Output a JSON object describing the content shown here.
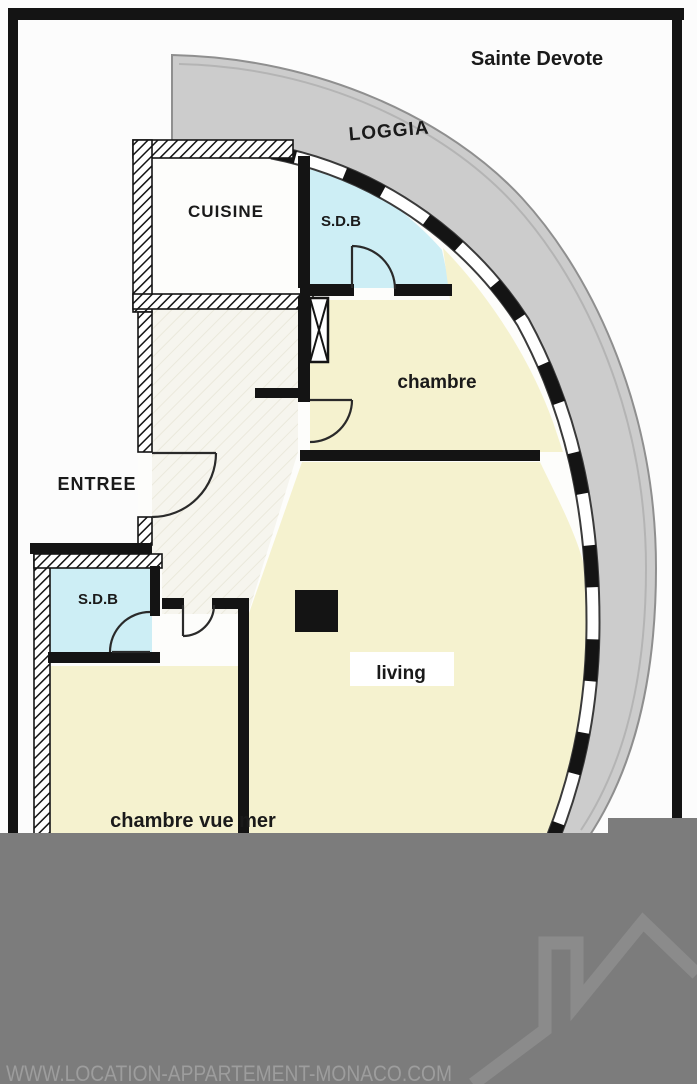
{
  "plan": {
    "region_label": "Sainte Devote",
    "rooms": {
      "loggia": "LOGGIA",
      "cuisine": "CUISINE",
      "sdb_top": "S.D.B",
      "chambre": "chambre",
      "entree": "ENTREE",
      "sdb_bottom": "S.D.B",
      "living": "living",
      "chambre_vue_mer": "chambre vue mer"
    },
    "colors": {
      "wall": "#141414",
      "label_text": "#1a1a1a",
      "loggia_fill": "#cccccc",
      "loggia_edge": "#8f8f8f",
      "room_yellow": "#f5f2cf",
      "bathroom_blue": "#cdeef5",
      "apartment_floor": "#fdfdfb",
      "overlay_gray": "#7c7c7c",
      "watermark_gray": "#8b8b8b",
      "url_text_color": "#9d9d9d"
    }
  },
  "watermark": {
    "url_text": "WWW.LOCATION-APPARTEMENT-MONACO.COM"
  }
}
